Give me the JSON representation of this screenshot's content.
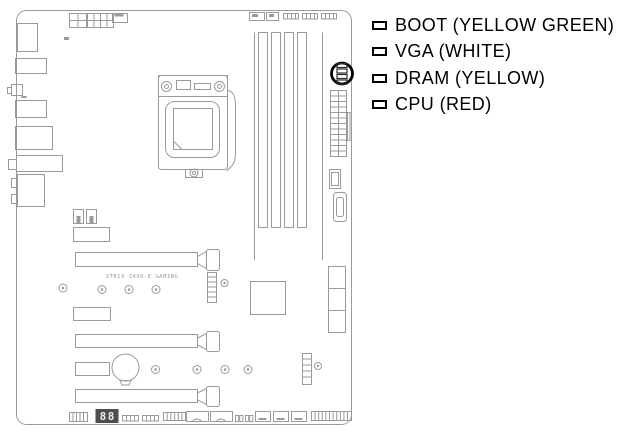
{
  "legend": {
    "items": [
      {
        "id": "boot",
        "label": "BOOT (YELLOW GREEN)",
        "led_color_name": "yellow green"
      },
      {
        "id": "vga",
        "label": "VGA (WHITE)",
        "led_color_name": "white"
      },
      {
        "id": "dram",
        "label": "DRAM (YELLOW)",
        "led_color_name": "yellow"
      },
      {
        "id": "cpu",
        "label": "CPU (RED)",
        "led_color_name": "red"
      }
    ]
  },
  "board": {
    "label": "STRIX Z490-E GAMING",
    "debug_display": "88"
  },
  "colors": {
    "line_art": "#9a9a9a",
    "highlight_ring": "#000000",
    "legend_text": "#000000",
    "debug_display_bg": "#4d4d4d",
    "debug_display_digits": "#ececec",
    "background": "#ffffff"
  }
}
